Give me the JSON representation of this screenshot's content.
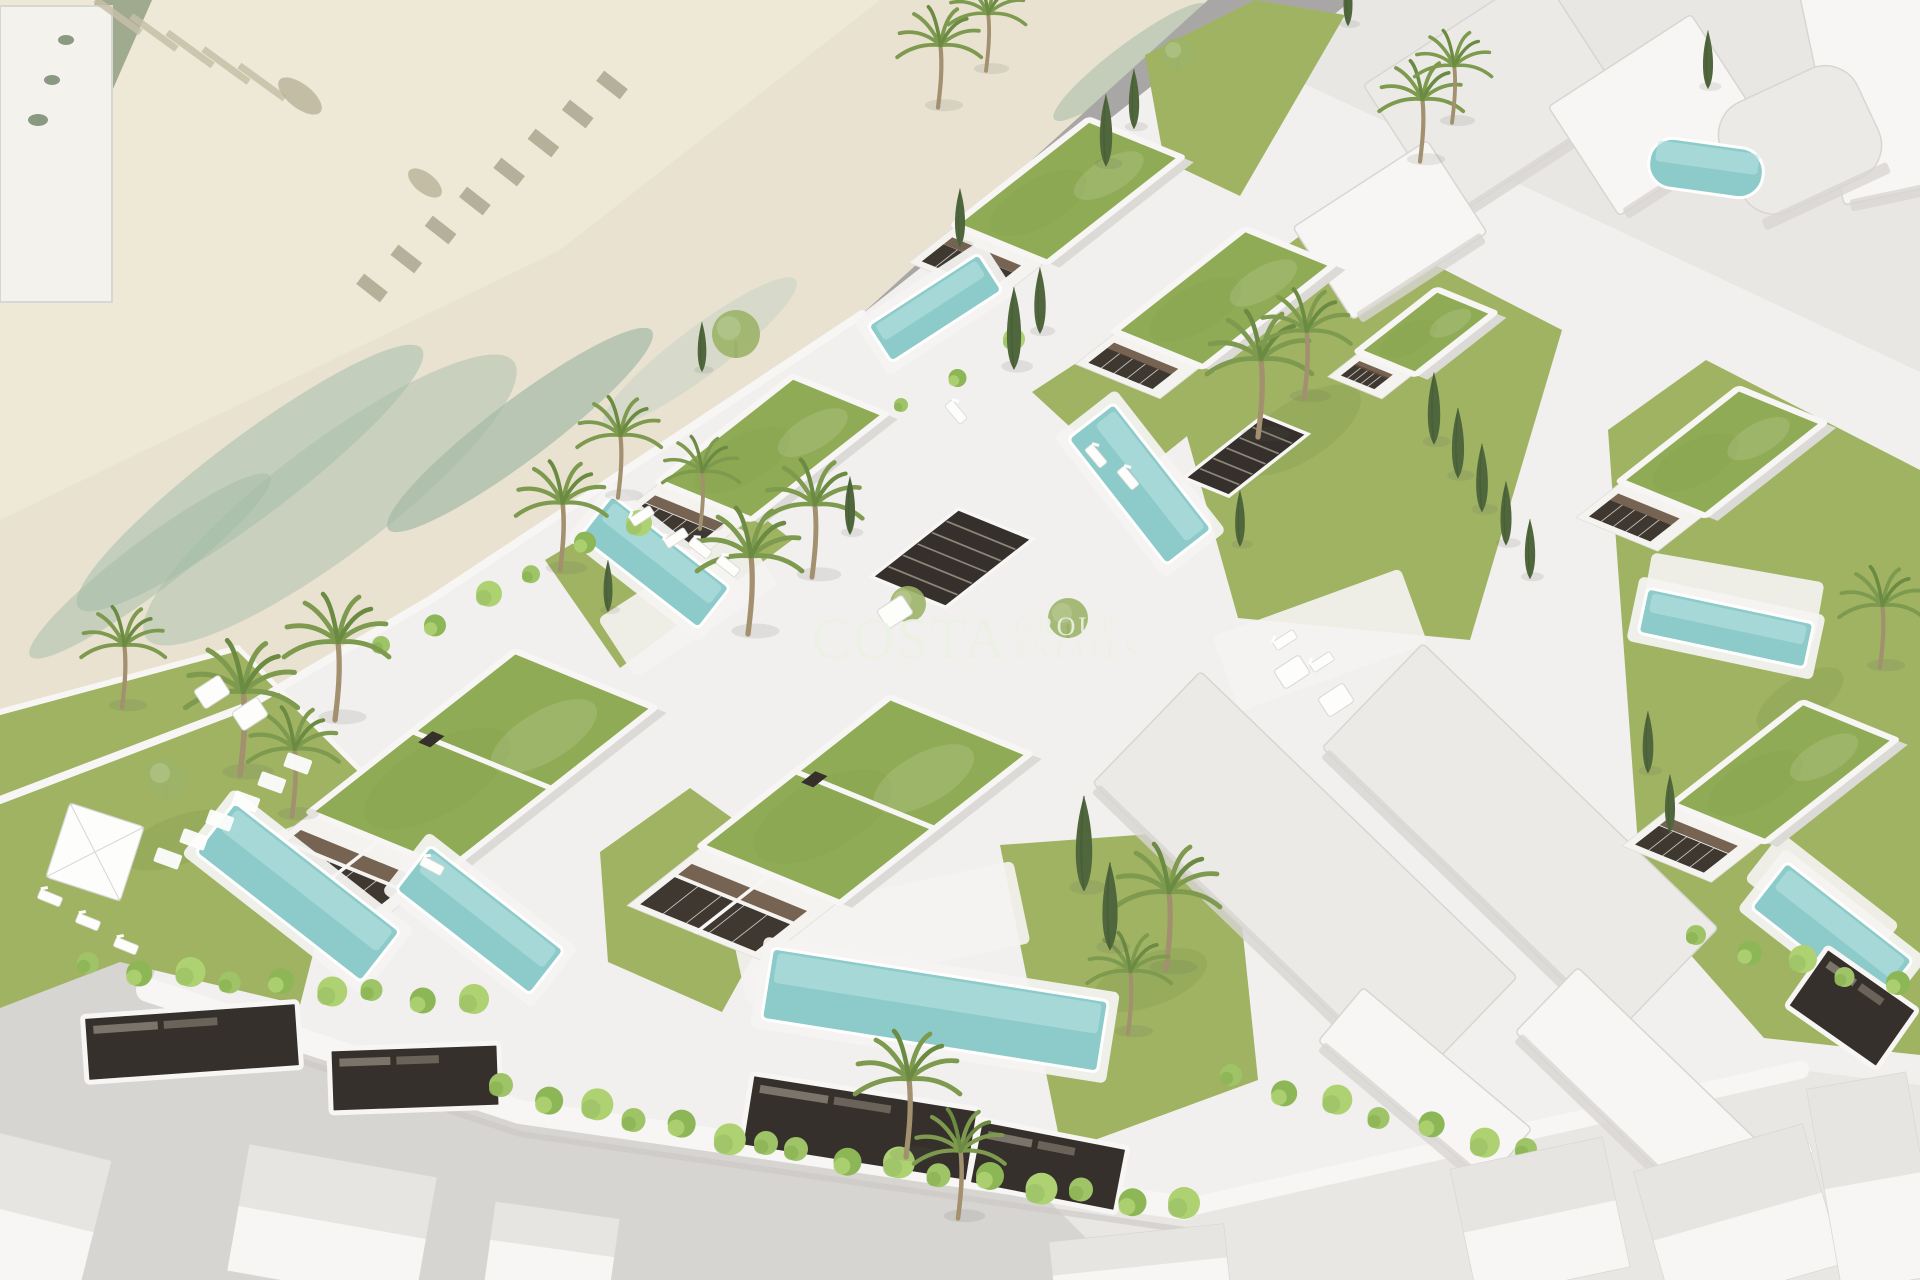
{
  "watermark": {
    "brand": "COSTA",
    "group_label": "GROUP",
    "estates_label": "ESTATES"
  },
  "colors": {
    "base": "#dddbd8",
    "sand": "#e9e2d1",
    "sandLight": "#f2ecdc",
    "sandRow": "#c6bfa8",
    "sandRowDark": "#a9a68f",
    "leftStrip": "#97a387",
    "stripSpot": "#6f8266",
    "blotch": "#b9b198",
    "foam1": "#bccbb9",
    "foam2": "#a4bba6",
    "foam3": "#cbd6c5",
    "roadUpper": "#a8a7a5",
    "roadStripe": "#b6b5b3",
    "roadLower": "#d7d5d2",
    "rightGround": "#e8e7e4",
    "platform": "#f1f0ee",
    "wall": "#f7f6f4",
    "wallShadow": "#c9c7c3",
    "lawn": "#9fb363",
    "lawnDark": "#87a14f",
    "roof": "#8fab55",
    "pool": "#8ccbc9",
    "poolHi": "#bce4e1",
    "poolDeck": "#f4f3f1",
    "facade": "#f4f3f0",
    "facadeEdge": "#e2e0dc",
    "side": "#dcdad6",
    "window": "#3f3831",
    "wood": "#5f4936",
    "massing": "#eceae7",
    "massingSide": "#d8d6d2",
    "garage": "#35302b",
    "slat": "#8d867a",
    "houseBase": "#f0eeec",
    "houseRoofA": "#e7e5e1",
    "houseRoofB": "#f7f6f4",
    "houseEdge": "#d9d7d3",
    "bushA": "#9fc468",
    "bushB": "#8db656",
    "bushC": "#aed172",
    "palm": "#7d9a4e",
    "palmDark": "#6b8a42",
    "trunk": "#a2906f",
    "cypress": "#50673d",
    "treeRound": "#9cb468",
    "white": "#fdfdfc",
    "furnitureEdge": "#d8d6d2",
    "watermark": "#edf2e5",
    "topLeftRoof": "#f4f2ec"
  },
  "scene": {
    "beach": [
      {
        "d": "M0,0 L1208,0 L862,314 L430,600 L250,705 L0,800 Z",
        "f": "sand"
      },
      {
        "d": "M0,0 L880,0 L560,250 L0,520 Z",
        "f": "sandLight",
        "o": 0.55
      },
      {
        "d": "M96,0 L152,0 L62,205 L18,236 Z",
        "f": "leftStrip",
        "o": 0.9
      }
    ],
    "topLeftBuilding": {
      "x": 0,
      "y": 6,
      "w": 112,
      "h": 296
    },
    "chains": [
      {
        "x1": 612,
        "y1": 85,
        "x2": 372,
        "y2": 288,
        "n": 8,
        "w": 30,
        "h": 13,
        "rot": 38,
        "f": "sandRowDark"
      },
      {
        "x1": 118,
        "y1": 16,
        "x2": 262,
        "y2": 82,
        "n": 5,
        "w": 56,
        "h": 7,
        "rot": 36,
        "f": "sandRow"
      }
    ],
    "spots": [
      {
        "cx": 300,
        "cy": 96,
        "rx": 26,
        "ry": 12,
        "rot": 38,
        "f": "blotch",
        "o": 0.8
      },
      {
        "cx": 425,
        "cy": 183,
        "rx": 20,
        "ry": 10,
        "rot": 38,
        "f": "blotch",
        "o": 0.8
      },
      {
        "cx": 38,
        "cy": 120,
        "rx": 10,
        "ry": 6,
        "rot": 0,
        "f": "stripSpot",
        "o": 0.8
      },
      {
        "cx": 52,
        "cy": 80,
        "rx": 8,
        "ry": 5,
        "rot": 0,
        "f": "stripSpot",
        "o": 0.8
      },
      {
        "cx": 66,
        "cy": 40,
        "rx": 8,
        "ry": 5,
        "rot": 0,
        "f": "stripSpot",
        "o": 0.8
      }
    ],
    "streaks": [
      {
        "cx": 250,
        "cy": 478,
        "rx": 215,
        "ry": 40,
        "rot": -37,
        "f": "foam1",
        "o": 0.85
      },
      {
        "cx": 520,
        "cy": 430,
        "rx": 165,
        "ry": 30,
        "rot": -37,
        "f": "foam2",
        "o": 0.7
      },
      {
        "cx": 700,
        "cy": 352,
        "rx": 120,
        "ry": 24,
        "rot": -37,
        "f": "foam3",
        "o": 0.6
      },
      {
        "cx": 330,
        "cy": 500,
        "rx": 230,
        "ry": 56,
        "rot": -37,
        "f": "foam2",
        "o": 0.45
      },
      {
        "cx": 150,
        "cy": 566,
        "rx": 150,
        "ry": 26,
        "rot": -37,
        "f": "foam2",
        "o": 0.5
      },
      {
        "cx": 1130,
        "cy": 62,
        "rx": 95,
        "ry": 18,
        "rot": -37,
        "f": "foam2",
        "o": 0.55
      },
      {
        "cx": 1242,
        "cy": 40,
        "rx": 70,
        "ry": 13,
        "rot": -37,
        "f": "foam3",
        "o": 0.5
      },
      {
        "cx": 1190,
        "cy": 120,
        "rx": 70,
        "ry": 12,
        "rot": -37,
        "f": "foam1",
        "o": 0.5
      }
    ],
    "roads": [
      {
        "d": "M1208,0 L1352,0 L520,672 L232,800 L0,906 L0,800 L250,705 L430,600 L862,314 Z",
        "f": "roadUpper"
      },
      {
        "d": "M1352,0 L1920,0 L1920,1280 L1128,1280 L520,672 Z",
        "f": "rightGround"
      },
      {
        "d": "M0,906 L232,800 L520,672 L1128,1280 L0,1280 Z",
        "f": "roadLower"
      }
    ],
    "roadLines": [
      {
        "x1": 1268,
        "y1": 14,
        "x2": 320,
        "y2": 760,
        "w": 26,
        "o": 0.45
      }
    ],
    "platform": [
      {
        "d": "M862,314 L1210,40 L1500,175 L1920,372 L1920,1085 L1800,1070 L1185,1208 L520,1112 L148,990 L250,705 L430,600 Z",
        "f": "platform"
      }
    ],
    "lawns": [
      {
        "d": "M0,712 L238,648 L360,770 L300,1005 L120,962 L0,1008 Z"
      },
      {
        "d": "M545,560 L700,468 L792,540 L620,668 Z"
      },
      {
        "d": "M600,852 L690,788 L802,868 L722,1012 L608,962 Z"
      },
      {
        "d": "M1160,340 L1332,212 L1562,330 L1470,640 L1238,618 Z"
      },
      {
        "d": "M1000,845 L1232,828 L1258,1080 L1062,1152 Z"
      },
      {
        "d": "M1608,430 L1706,360 L1920,470 L1920,1055 L1764,1038 L1642,900 Z"
      },
      {
        "d": "M1145,55 L1255,0 L1345,15 L1240,196 L1164,160 Z"
      },
      {
        "d": "M1032,392 L1130,328 L1232,400 L1130,482 Z"
      }
    ],
    "lawnSpots": [
      {
        "cx": 180,
        "cy": 840,
        "rx": 60,
        "ry": 24,
        "rot": -20
      },
      {
        "cx": 1300,
        "cy": 430,
        "rx": 70,
        "ry": 30,
        "rot": -33
      },
      {
        "cx": 1150,
        "cy": 980,
        "rx": 60,
        "ry": 26,
        "rot": -20
      },
      {
        "cx": 1800,
        "cy": 700,
        "rx": 50,
        "ry": 22,
        "rot": -33
      }
    ],
    "walls": [
      {
        "d": "M862,314 L430,600 L250,705 L0,800",
        "s": "wall",
        "w": 8
      },
      {
        "d": "M148,990 L520,1112 L1185,1208",
        "s": "wall",
        "w": 24
      },
      {
        "d": "M155,1012 L520,1134 L1185,1230",
        "s": "wallShadow",
        "w": 6,
        "o": 0.6
      },
      {
        "d": "M1185,1208 L1800,1070",
        "s": "wall",
        "w": 18
      },
      {
        "d": "M0,712 L238,648",
        "s": "wall",
        "w": 6
      },
      {
        "d": "M238,648 L360,770",
        "s": "wall",
        "w": 5
      }
    ],
    "terraces": [
      {
        "cx": 352,
        "cy": 842,
        "w": 170,
        "h": 70,
        "rot": -20
      },
      {
        "cx": 880,
        "cy": 932,
        "w": 290,
        "h": 84,
        "rot": -12
      },
      {
        "cx": 688,
        "cy": 602,
        "w": 170,
        "h": 70,
        "rot": -33
      },
      {
        "cx": 1733,
        "cy": 598,
        "w": 175,
        "h": 62,
        "rot": 10
      },
      {
        "cx": 1822,
        "cy": 902,
        "w": 150,
        "h": 60,
        "rot": 38
      },
      {
        "cx": 1320,
        "cy": 640,
        "w": 200,
        "h": 80,
        "rot": -20
      }
    ],
    "massing": [
      {
        "cx": 1305,
        "cy": 880,
        "w": 440,
        "h": 155,
        "rot": 44,
        "f": "massing"
      },
      {
        "cx": 1520,
        "cy": 838,
        "w": 410,
        "h": 145,
        "rot": 44,
        "f": "massing"
      },
      {
        "cx": 1640,
        "cy": 1090,
        "w": 260,
        "h": 90,
        "rot": 44,
        "f": "wall"
      },
      {
        "cx": 1425,
        "cy": 1085,
        "w": 220,
        "h": 70,
        "rot": 40,
        "f": "wall"
      },
      {
        "cx": 1495,
        "cy": 95,
        "w": 210,
        "h": 160,
        "rot": -33,
        "f": "massing"
      },
      {
        "cx": 1655,
        "cy": 115,
        "w": 170,
        "h": 130,
        "rot": -33,
        "f": "wall"
      },
      {
        "cx": 1880,
        "cy": 85,
        "w": 120,
        "h": 220,
        "rot": -12,
        "f": "wall"
      },
      {
        "cx": 1800,
        "cy": 140,
        "w": 150,
        "h": 120,
        "rot": -25,
        "f": "massing",
        "r": 36
      },
      {
        "cx": 1390,
        "cy": 230,
        "w": 160,
        "h": 110,
        "rot": -33,
        "f": "wall"
      }
    ],
    "pergolas": [
      {
        "cx": 952,
        "cy": 558,
        "w": 110,
        "h": 80
      },
      {
        "cx": 1004,
        "cy": 260,
        "w": 80,
        "h": 42
      },
      {
        "cx": 712,
        "cy": 472,
        "w": 60,
        "h": 40
      },
      {
        "cx": 1246,
        "cy": 456,
        "w": 100,
        "h": 48
      }
    ],
    "villas": [
      {
        "cx": 1068,
        "cy": 191,
        "w": 170,
        "h": 100,
        "fh": 60,
        "split": false
      },
      {
        "cx": 1224,
        "cy": 298,
        "w": 165,
        "h": 95,
        "fh": 52,
        "split": false
      },
      {
        "cx": 772,
        "cy": 448,
        "w": 170,
        "h": 100,
        "fh": 66,
        "split": false
      },
      {
        "cx": 482,
        "cy": 760,
        "w": 260,
        "h": 150,
        "fh": 95,
        "split": true
      },
      {
        "cx": 865,
        "cy": 800,
        "w": 240,
        "h": 150,
        "fh": 95,
        "split": true
      },
      {
        "cx": 1722,
        "cy": 452,
        "w": 150,
        "h": 92,
        "fh": 58,
        "split": false
      },
      {
        "cx": 1784,
        "cy": 772,
        "w": 165,
        "h": 100,
        "fh": 66,
        "split": false
      },
      {
        "cx": 1426,
        "cy": 332,
        "w": 100,
        "h": 62,
        "fh": 40,
        "split": false
      }
    ],
    "pools": [
      {
        "cx": 298,
        "cy": 892,
        "w": 210,
        "h": 64,
        "rot": 38
      },
      {
        "cx": 480,
        "cy": 920,
        "w": 170,
        "h": 56,
        "rot": 38
      },
      {
        "cx": 935,
        "cy": 1010,
        "w": 340,
        "h": 72,
        "rot": 9
      },
      {
        "cx": 655,
        "cy": 562,
        "w": 150,
        "h": 52,
        "rot": 38
      },
      {
        "cx": 935,
        "cy": 308,
        "w": 132,
        "h": 44,
        "rot": -33
      },
      {
        "cx": 1140,
        "cy": 484,
        "w": 160,
        "h": 58,
        "rot": 52
      },
      {
        "cx": 1726,
        "cy": 628,
        "w": 170,
        "h": 46,
        "rot": 12
      },
      {
        "cx": 1832,
        "cy": 934,
        "w": 160,
        "h": 58,
        "rot": 38
      },
      {
        "cx": 1706,
        "cy": 168,
        "w": 115,
        "h": 50,
        "rot": 8,
        "r": 24,
        "noDeck": true
      }
    ],
    "garages": [
      {
        "cx": 192,
        "cy": 1042,
        "w": 215,
        "h": 66,
        "rot": -4
      },
      {
        "cx": 415,
        "cy": 1078,
        "w": 170,
        "h": 64,
        "rot": -2
      },
      {
        "cx": 860,
        "cy": 1128,
        "w": 230,
        "h": 74,
        "rot": 9
      },
      {
        "cx": 1048,
        "cy": 1166,
        "w": 150,
        "h": 66,
        "rot": 11
      },
      {
        "cx": 1852,
        "cy": 1008,
        "w": 110,
        "h": 72,
        "rot": 35
      }
    ],
    "hedges": [
      {
        "x1": 92,
        "y1": 966,
        "x2": 470,
        "y2": 1002,
        "n": 9,
        "s": 13
      },
      {
        "x1": 505,
        "y1": 1088,
        "x2": 770,
        "y2": 1146,
        "n": 7,
        "s": 14
      },
      {
        "x1": 800,
        "y1": 1152,
        "x2": 1180,
        "y2": 1206,
        "n": 9,
        "s": 14
      },
      {
        "x1": 1235,
        "y1": 1078,
        "x2": 1530,
        "y2": 1152,
        "n": 7,
        "s": 13
      },
      {
        "x1": 1700,
        "y1": 938,
        "x2": 1898,
        "y2": 986,
        "n": 5,
        "s": 12
      },
      {
        "x1": 385,
        "y1": 648,
        "x2": 635,
        "y2": 520,
        "n": 6,
        "s": 11
      },
      {
        "x1": 905,
        "y1": 408,
        "x2": 1010,
        "y2": 342,
        "n": 3,
        "s": 9
      }
    ],
    "palms": [
      [
        240,
        762,
        1.6
      ],
      [
        335,
        708,
        1.5
      ],
      [
        292,
        806,
        1.3
      ],
      [
        560,
        560,
        1.3
      ],
      [
        618,
        488,
        1.2
      ],
      [
        748,
        622,
        1.5
      ],
      [
        812,
        566,
        1.4
      ],
      [
        700,
        520,
        1.1
      ],
      [
        938,
        98,
        1.2
      ],
      [
        986,
        62,
        1.1
      ],
      [
        1258,
        425,
        1.5
      ],
      [
        1304,
        388,
        1.3
      ],
      [
        1420,
        152,
        1.2
      ],
      [
        1452,
        114,
        1.1
      ],
      [
        906,
        1145,
        1.5
      ],
      [
        958,
        1208,
        1.3
      ],
      [
        1166,
        958,
        1.5
      ],
      [
        1128,
        1024,
        1.2
      ],
      [
        1880,
        658,
        1.2
      ],
      [
        122,
        698,
        1.2
      ]
    ],
    "cypresses": [
      [
        1106,
        158,
        72
      ],
      [
        1134,
        122,
        60
      ],
      [
        1014,
        360,
        82
      ],
      [
        1040,
        326,
        66
      ],
      [
        850,
        528,
        58
      ],
      [
        1434,
        436,
        72
      ],
      [
        1458,
        470,
        70
      ],
      [
        1482,
        504,
        68
      ],
      [
        1506,
        538,
        64
      ],
      [
        1530,
        572,
        60
      ],
      [
        1084,
        880,
        95
      ],
      [
        1110,
        940,
        88
      ],
      [
        1348,
        20,
        52
      ],
      [
        1708,
        82,
        58
      ],
      [
        1648,
        766,
        62
      ],
      [
        1670,
        826,
        58
      ],
      [
        608,
        606,
        52
      ],
      [
        960,
        240,
        58
      ],
      [
        702,
        366,
        50
      ],
      [
        1240,
        540,
        56
      ]
    ],
    "trees": [
      [
        736,
        334,
        24
      ],
      [
        908,
        604,
        18
      ],
      [
        1068,
        618,
        20
      ],
      [
        1178,
        54,
        16
      ],
      [
        166,
        778,
        20
      ]
    ],
    "steppingStones": [
      [
        168,
        858
      ],
      [
        194,
        839
      ],
      [
        220,
        820
      ],
      [
        246,
        801
      ],
      [
        272,
        782
      ],
      [
        298,
        763
      ]
    ],
    "loungers": [
      [
        50,
        898,
        22
      ],
      [
        88,
        922,
        22
      ],
      [
        126,
        946,
        22
      ],
      [
        642,
        516,
        -33
      ],
      [
        676,
        538,
        -33
      ],
      [
        1096,
        456,
        50
      ],
      [
        1128,
        478,
        50
      ],
      [
        432,
        866,
        28
      ],
      [
        1800,
        1152,
        -20
      ],
      [
        1842,
        1176,
        -20
      ],
      [
        956,
        412,
        50
      ],
      [
        1285,
        640,
        -33
      ],
      [
        1322,
        662,
        -33
      ],
      [
        700,
        548,
        38
      ],
      [
        728,
        566,
        38
      ]
    ],
    "cubes": [
      [
        1292,
        672
      ],
      [
        1336,
        700
      ],
      [
        212,
        692
      ],
      [
        250,
        714
      ],
      [
        895,
        612
      ]
    ],
    "umbrella": {
      "cx": 95,
      "cy": 852,
      "s": 78,
      "rot": 18
    },
    "houses": [
      {
        "cx": 30,
        "cy": 1218,
        "w": 130,
        "h": 150,
        "rot": 14
      },
      {
        "cx": 332,
        "cy": 1224,
        "w": 190,
        "h": 128,
        "rot": 10
      },
      {
        "cx": 552,
        "cy": 1250,
        "w": 125,
        "h": 80,
        "rot": 8
      },
      {
        "cx": 1140,
        "cy": 1268,
        "w": 175,
        "h": 70,
        "rot": -6
      },
      {
        "cx": 1540,
        "cy": 1218,
        "w": 155,
        "h": 132,
        "rot": -12
      },
      {
        "cx": 1738,
        "cy": 1218,
        "w": 175,
        "h": 145,
        "rot": -16
      },
      {
        "cx": 1874,
        "cy": 1182,
        "w": 100,
        "h": 205,
        "rot": -10
      }
    ]
  }
}
